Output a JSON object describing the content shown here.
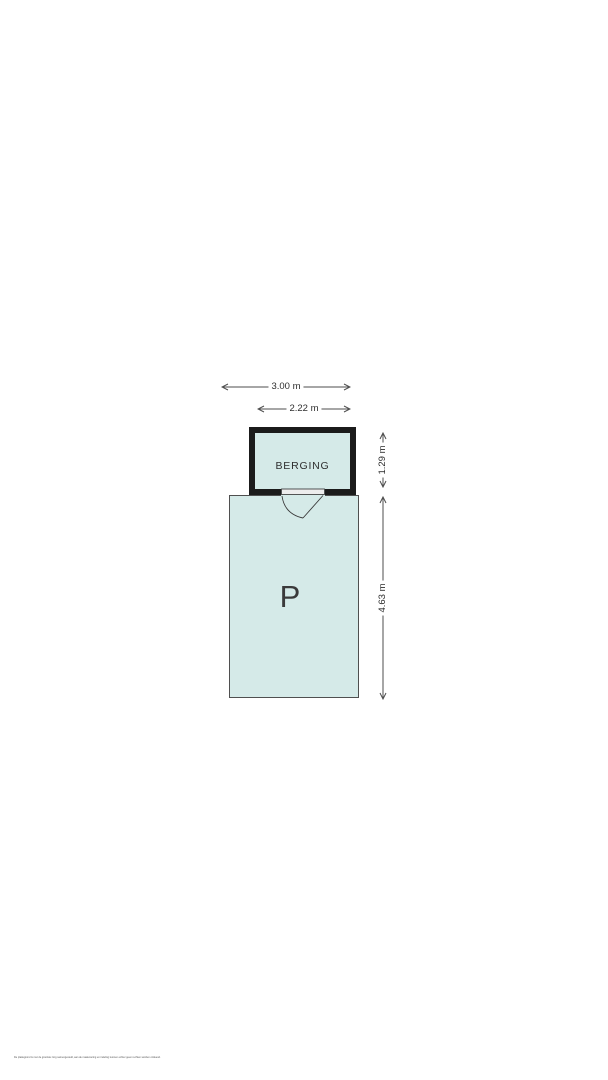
{
  "floorplan": {
    "rooms": {
      "berging": {
        "label": "BERGING"
      },
      "parking": {
        "label": "P"
      }
    },
    "dimensions": {
      "top_outer": "3.00 m",
      "top_inner": "2.22 m",
      "right_upper": "1.29 m",
      "right_lower": "4.63 m"
    },
    "colors": {
      "wall": "#1b1b1b",
      "room_fill": "#d5eae8",
      "door_fill": "#ededed",
      "dim_line": "#4d4d4d",
      "text": "#2e2e2e"
    }
  },
  "footer": {
    "disclaimer": "De plattegrond is met de grootste zorg samengesteld, aan de maatvoering en indeling kunnen echter geen rechten worden ontleend."
  }
}
